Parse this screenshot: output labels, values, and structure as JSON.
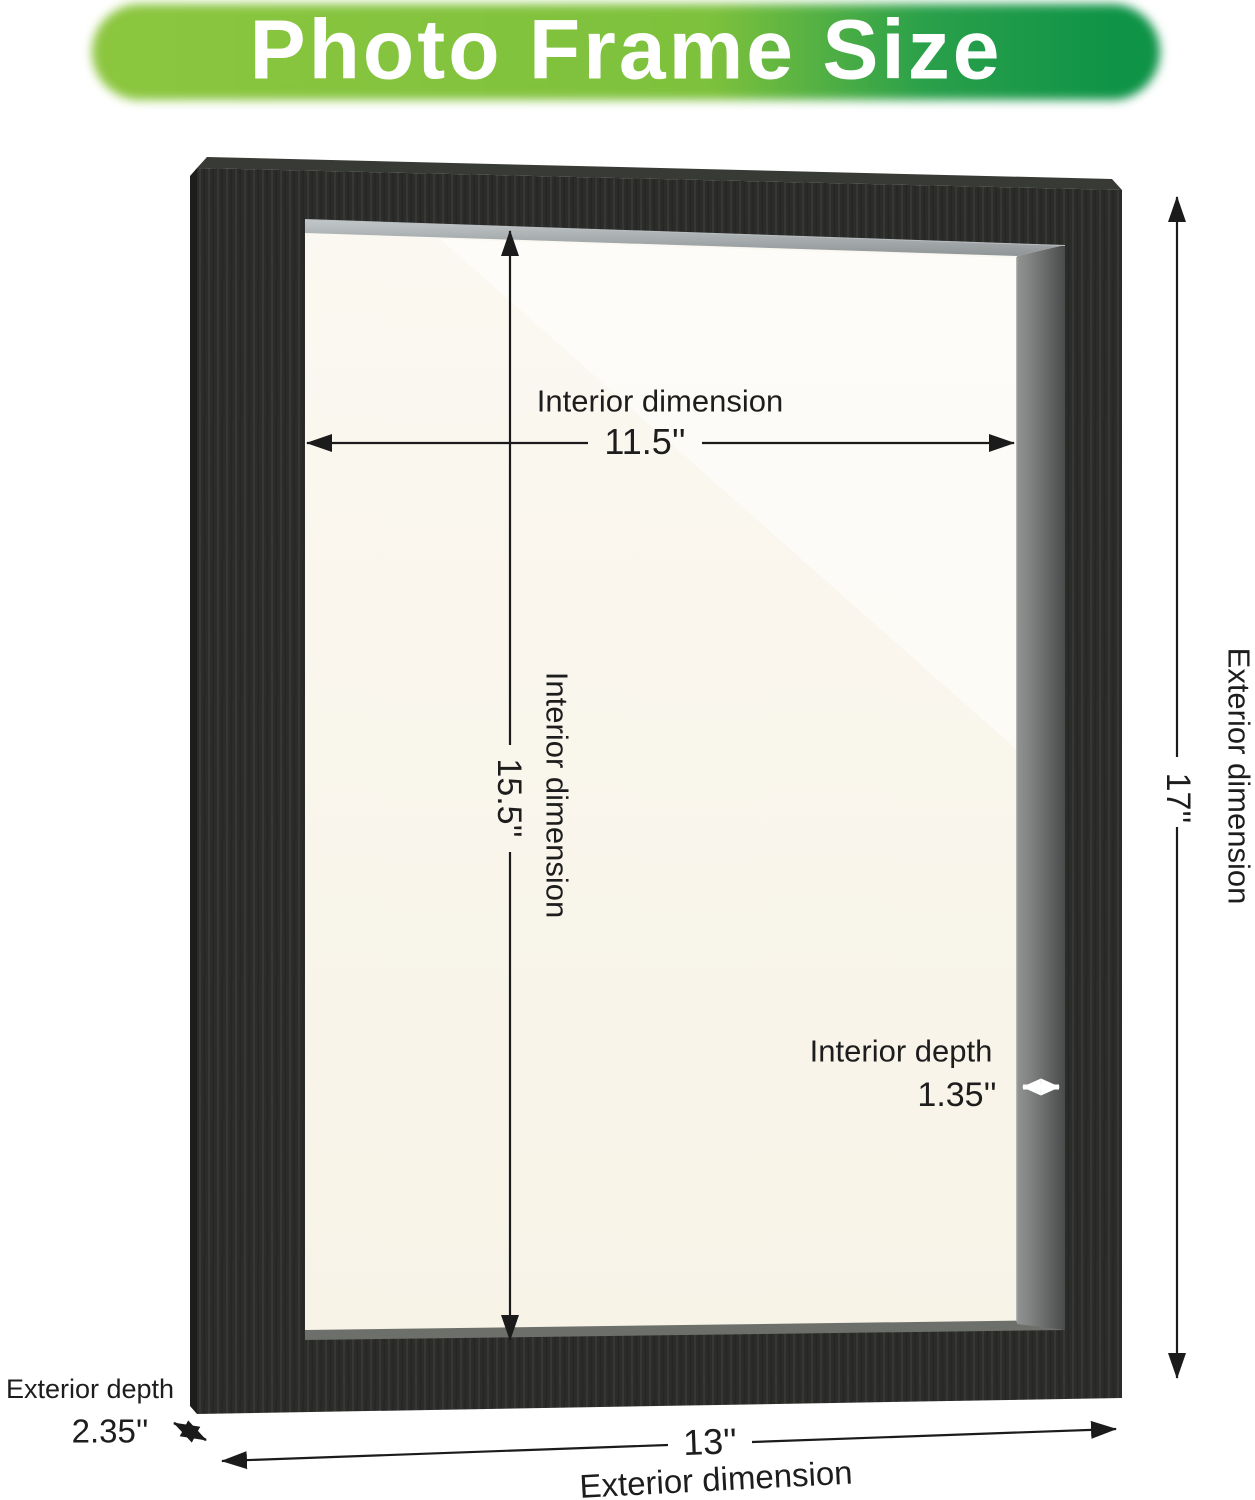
{
  "banner": {
    "title": "Photo Frame Size"
  },
  "dimensions": {
    "interior_width": {
      "label": "Interior dimension",
      "value": "11.5''"
    },
    "interior_height": {
      "label": "Interior dimension",
      "value": "15.5''"
    },
    "interior_depth": {
      "label": "Interior depth",
      "value": "1.35''"
    },
    "exterior_height": {
      "label": "Exterior dimension",
      "value": "17''"
    },
    "exterior_width": {
      "label": "Exterior dimension",
      "value": "13''"
    },
    "exterior_depth": {
      "label": "Exterior depth",
      "value": "2.35''"
    }
  },
  "colors": {
    "banner_green_light": "#7dc13c",
    "banner_green_dark": "#0e9347",
    "banner_text": "#ffffff",
    "frame_front": "#2c2d2a",
    "interior_side_wall": "#7e8180",
    "interior_top_wall": "#aab0b3",
    "backing_cream": "#f9f5eb",
    "annotation_text": "#1d1d1d",
    "background": "#ffffff"
  }
}
